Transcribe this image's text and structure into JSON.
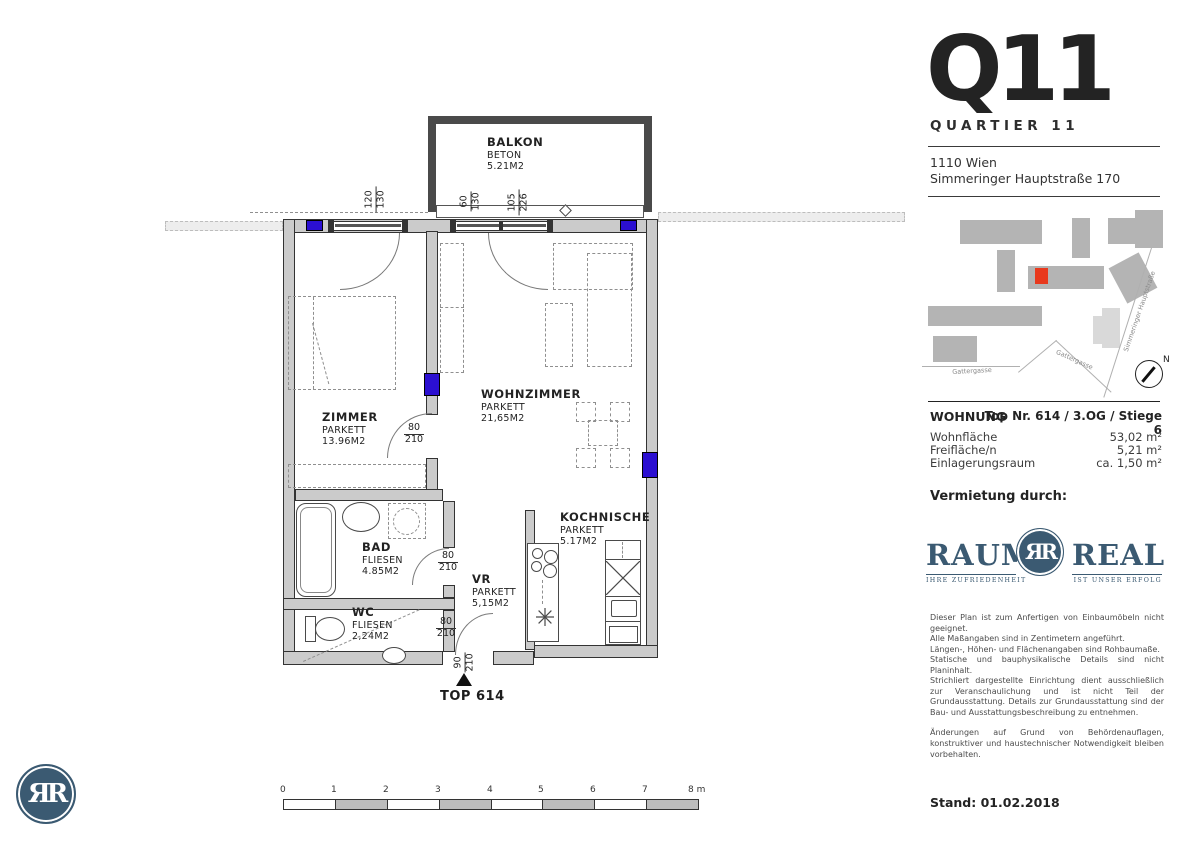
{
  "header": {
    "brand": "Q11",
    "subtitle": "QUARTIER 11",
    "address_line1": "1110 Wien",
    "address_line2": "Simmeringer Hauptstraße 170"
  },
  "site_map": {
    "street_bottom": "Gattergasse",
    "street_curve": "Gattergasse",
    "street_right": "Simmeringer Hauptstraße",
    "compass": "N"
  },
  "wohnung": {
    "title": "WOHNUNG",
    "unit": "Top Nr. 614 / 3.OG / Stiege 6",
    "rows": [
      {
        "label": "Wohnfläche",
        "value": "53,02 m²"
      },
      {
        "label": "Freifläche/n",
        "value": "5,21 m²"
      },
      {
        "label": "Einlagerungsraum",
        "value": "ca. 1,50 m²"
      }
    ]
  },
  "vermietung_label": "Vermietung durch:",
  "raumreal": {
    "word_left": "RAUM",
    "word_right": "REAL",
    "monogram": "ЯR",
    "tagline_left": "IHRE ZUFRIEDENHEIT",
    "tagline_right": "IST UNSER ERFOLG"
  },
  "disclaimer": {
    "lines": [
      "Dieser Plan ist zum Anfertigen von Einbaumöbeln nicht geeignet.",
      "Alle Maßangaben sind in Zentimetern angeführt.",
      "Längen-, Höhen- und Flächenangaben sind Rohbaumaße.",
      "Statische und bauphysikalische Details sind nicht Planinhalt.",
      "Strichliert dargestellte Einrichtung dient ausschließlich zur Veranschaulichung und ist nicht Teil der Grundausstattung. Details zur Grundausstattung sind der Bau- und Ausstattungsbeschreibung zu entnehmen."
    ],
    "p2": "Änderungen auf Grund von Behördenauflagen, konstruktiver und haustechnischer Notwendigkeit bleiben vorbehalten."
  },
  "stand": "Stand: 01.02.2018",
  "floorplan": {
    "rooms": {
      "balkon": {
        "name": "BALKON",
        "finish": "BETON",
        "area": "5.21M2"
      },
      "zimmer": {
        "name": "ZIMMER",
        "finish": "PARKETT",
        "area": "13.96M2"
      },
      "wohnzimmer": {
        "name": "WOHNZIMMER",
        "finish": "PARKETT",
        "area": "21,65M2"
      },
      "bad": {
        "name": "BAD",
        "finish": "FLIESEN",
        "area": "4.85M2"
      },
      "wc": {
        "name": "WC",
        "finish": "FLIESEN",
        "area": "2,24M2"
      },
      "vr": {
        "name": "VR",
        "finish": "PARKETT",
        "area": "5,15M2"
      },
      "kochnische": {
        "name": "KOCHNISCHE",
        "finish": "PARKETT",
        "area": "5.17M2"
      }
    },
    "doors": {
      "zimmer": {
        "w": "80",
        "h": "210"
      },
      "bad": {
        "w": "80",
        "h": "210"
      },
      "wc": {
        "w": "80",
        "h": "210"
      },
      "entry": {
        "w": "90",
        "h": "210"
      }
    },
    "dims": {
      "d1": {
        "a": "120",
        "b": "130"
      },
      "d2": {
        "a": "60",
        "b": "130"
      },
      "d3": {
        "a": "105",
        "b": "226"
      }
    },
    "entry_label": "TOP 614",
    "scale_ticks": [
      "0",
      "1",
      "2",
      "3",
      "4",
      "5",
      "6",
      "7",
      "8 m"
    ]
  },
  "colors": {
    "accent_blue": "#2b0fd1",
    "map_red": "#e8391d",
    "brand_blue": "#3b5a72",
    "wall_gray": "#cbcbcb"
  }
}
